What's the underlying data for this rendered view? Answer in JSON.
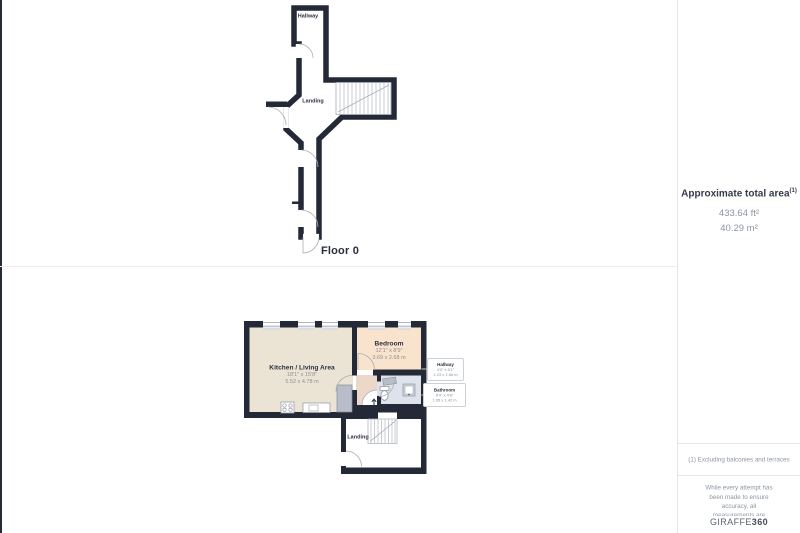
{
  "colors": {
    "wall": "#232936",
    "kitchen_fill": "#ebe4d5",
    "bedroom_fill": "#f9e3cc",
    "hallway_fill": "#edd7c8",
    "bathroom_fill": "#dee2eb",
    "fixture_gray": "#b8bec9",
    "label_dark": "#2b3140",
    "label_gray": "#8d929c"
  },
  "floor0": {
    "label": "Floor 0",
    "rooms": {
      "hallway": {
        "name": "Hallway"
      },
      "landing": {
        "name": "Landing"
      }
    }
  },
  "floor1": {
    "rooms": {
      "kitchen": {
        "name": "Kitchen / Living Area",
        "imperial": "18'1\" x 15'8\"",
        "metric": "5.52 x 4.78 m"
      },
      "bedroom": {
        "name": "Bedroom",
        "imperial": "12'1\" x 8'9\"",
        "metric": "3.69 x 2.68 m"
      },
      "landing": {
        "name": "Landing"
      },
      "hallway": {
        "name": "Hallway",
        "imperial": "4'0\" x 5'1\"",
        "metric": "1.23 x 1.56 m"
      },
      "bathroom": {
        "name": "Bathroom",
        "imperial": "6'4\" x 4'8\"",
        "metric": "1.95 x 1.42 m"
      }
    }
  },
  "sidebar": {
    "total_area_title": "Approximate total area",
    "total_area_note_ref": "(1)",
    "area_imperial": "433.64 ft²",
    "area_metric": "40.29 m²",
    "footnote": "(1) Excluding balconies and terraces",
    "disclaimer": "While every attempt has been made to ensure accuracy, all measurements are approximate, not to scale. This floor plan is for illustrative purposes only.",
    "brand": {
      "name": "GIRAFFE",
      "suffix": "360"
    }
  }
}
